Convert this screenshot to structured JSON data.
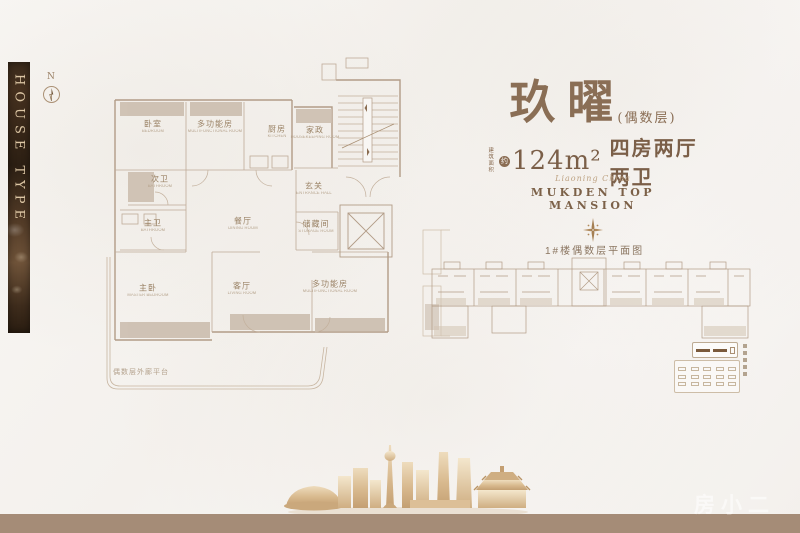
{
  "page": {
    "background": "#f6f4f1",
    "footer_bar_color": "#a58c77"
  },
  "sidebar": {
    "vertical_label": "HOUSE TYPE"
  },
  "compass": {
    "label": "N"
  },
  "floor_plan": {
    "rooms": [
      {
        "cn": "卧室",
        "en": "BEDROOM"
      },
      {
        "cn": "多功能房",
        "en": "MULTIFUNCTIONAL ROOM"
      },
      {
        "cn": "厨房",
        "en": "KITCHEN"
      },
      {
        "cn": "家政",
        "en": "HOUSEKEEPING ROOM"
      },
      {
        "cn": "次卫",
        "en": "BATHROOM"
      },
      {
        "cn": "主卫",
        "en": "BATHROOM"
      },
      {
        "cn": "餐厅",
        "en": "DINING ROOM"
      },
      {
        "cn": "玄关",
        "en": "ENTRANCE HALL"
      },
      {
        "cn": "储藏间",
        "en": "STORAGE ROOM"
      },
      {
        "cn": "主卧",
        "en": "MASTER BEDROOM"
      },
      {
        "cn": "客厅",
        "en": "LIVING ROOM"
      },
      {
        "cn": "多功能房",
        "en": "MULTIFUNCTIONAL ROOM"
      }
    ],
    "platform_note": "偶数层外廊平台"
  },
  "right_panel": {
    "title": "玖曜",
    "title_suffix": "(偶数层)",
    "area_prefix_line1": "建筑",
    "area_prefix_line2": "面积",
    "area_circle": "约",
    "area_value": "124m²",
    "area_spec": "四房两厅两卫",
    "script_line": "Liaoning China",
    "brand": "MUKDEN TOP MANSION",
    "diagram_label": "1#楼偶数层平面图"
  },
  "watermark": "房小二",
  "colors": {
    "accent_brown": "#8a6e55",
    "wall_line": "#b29c87",
    "fill_beige": "#ccbeaf",
    "banner_dark": "#3a2a1b"
  }
}
